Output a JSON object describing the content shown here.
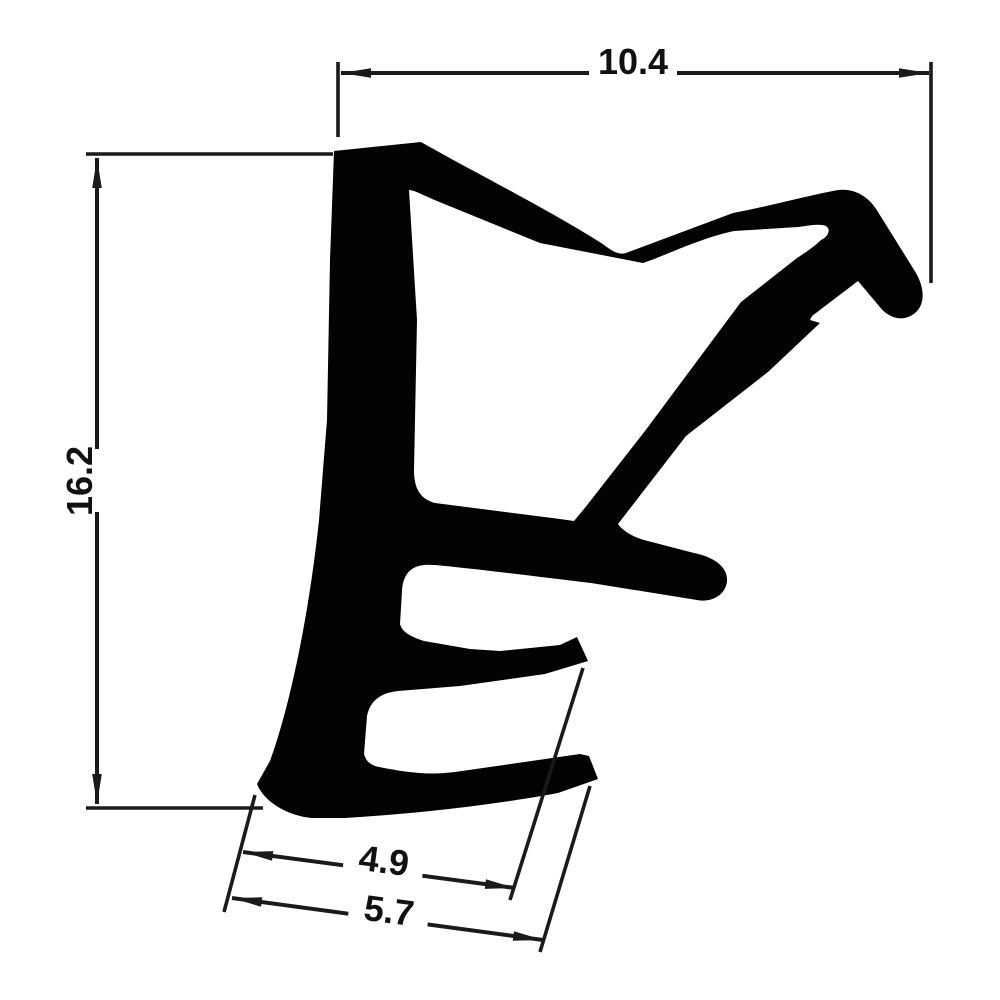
{
  "drawing": {
    "type": "technical-profile-cross-section",
    "background_color": "#ffffff",
    "profile_color": "#030303",
    "dimension_line_color": "#1a1a1a",
    "dimensions": {
      "top_width": "10.4",
      "left_height": "16.2",
      "bottom_inner_width": "4.9",
      "bottom_outer_width": "5.7"
    }
  }
}
